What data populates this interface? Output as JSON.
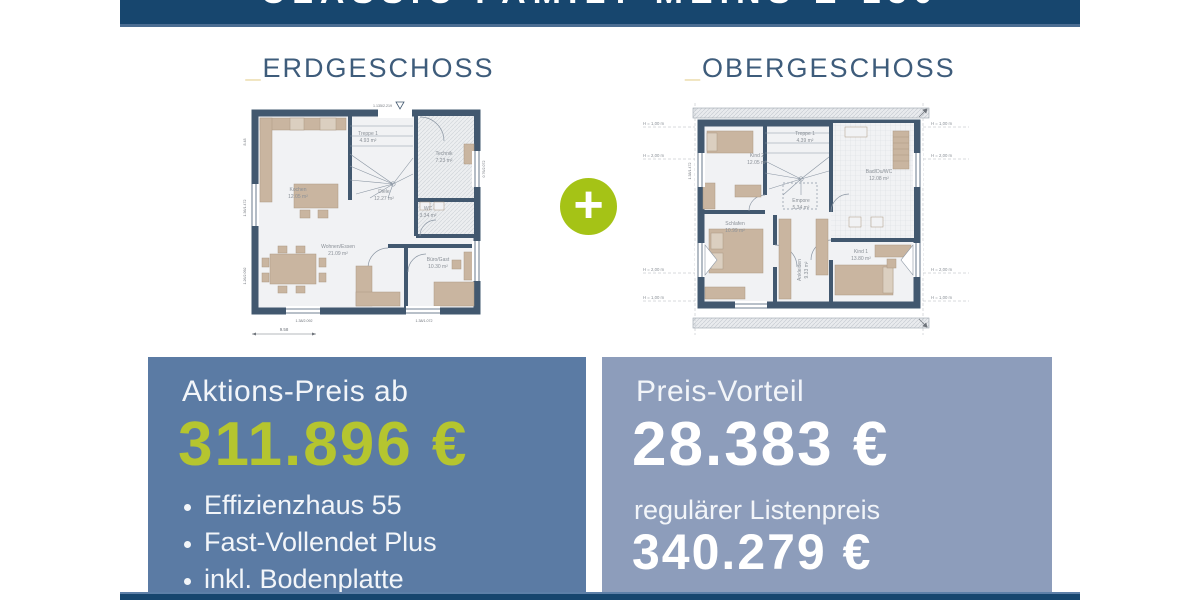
{
  "header": {
    "title": "CLASSIC FAMILY MEINS E-130"
  },
  "floors": {
    "eg": {
      "underscore": "_",
      "heading": "ERDGESCHOSS",
      "rooms": [
        {
          "name": "Kochen",
          "area": "12.05 m²"
        },
        {
          "name": "Treppe 1",
          "area": "4.93 m²"
        },
        {
          "name": "Technik",
          "area": "7.23 m²"
        },
        {
          "name": "Diele",
          "area": "12.27 m²"
        },
        {
          "name": "WC",
          "area": "3.34 m²"
        },
        {
          "name": "Wohnen/Essen",
          "area": "21.09 m²"
        },
        {
          "name": "Büro/Gast",
          "area": "10.30 m²"
        }
      ],
      "dims": {
        "total_width": "9.58",
        "total_height": "8.48",
        "entry": "1.135/2.219",
        "opening_bottom_left": "1.38/2.092",
        "opening_bottom_right": "1.38/1.072",
        "window_left_top": "1.36/1.472",
        "window_left_bottom": "1.26/2.092",
        "window_right_top": "0.76/2.072"
      }
    },
    "og": {
      "underscore": "_",
      "heading": "OBERGESCHOSS",
      "rooms": [
        {
          "name": "Kind 2",
          "area": "12.05 m²"
        },
        {
          "name": "Treppe 1",
          "area": "4.39 m²"
        },
        {
          "name": "Bad/Du/WC",
          "area": "12.08 m²"
        },
        {
          "name": "Empore",
          "area": "5.34 m²"
        },
        {
          "name": "Schlafen",
          "area": "10.99 m²"
        },
        {
          "name": "Ankleiden",
          "area": "9.33 m²"
        },
        {
          "name": "Kind 1",
          "area": "13.80 m²"
        }
      ],
      "height_marks": [
        "H = 1,00 m",
        "H = 2,00 m",
        "H = 2,00 m",
        "H = 1,00 m"
      ],
      "dims": {
        "window_side": "1.38/1.472"
      }
    }
  },
  "plus_badge": {
    "symbol": "+"
  },
  "offer_action": {
    "label": "Aktions-Preis ab",
    "price": "311.896 €",
    "features": [
      "Effizienzhaus 55",
      "Fast-Vollendet Plus",
      "inkl. Bodenplatte"
    ]
  },
  "offer_advantage": {
    "label": "Preis-Vorteil",
    "price": "28.383 €",
    "list_label": "regulärer Listenpreis",
    "list_price": "340.279 €"
  },
  "colors": {
    "navy": "#17466e",
    "heading_blue": "#3e5c7b",
    "gold_underscore": "#e3cc87",
    "lime_price": "#b5c52f",
    "lime_plus": "#a5c316",
    "box_action_bg": "#5b7ba4",
    "box_advantage_bg": "#8d9dbb",
    "plan_wall": "#42586f",
    "plan_furniture": "#c9b5a0"
  }
}
